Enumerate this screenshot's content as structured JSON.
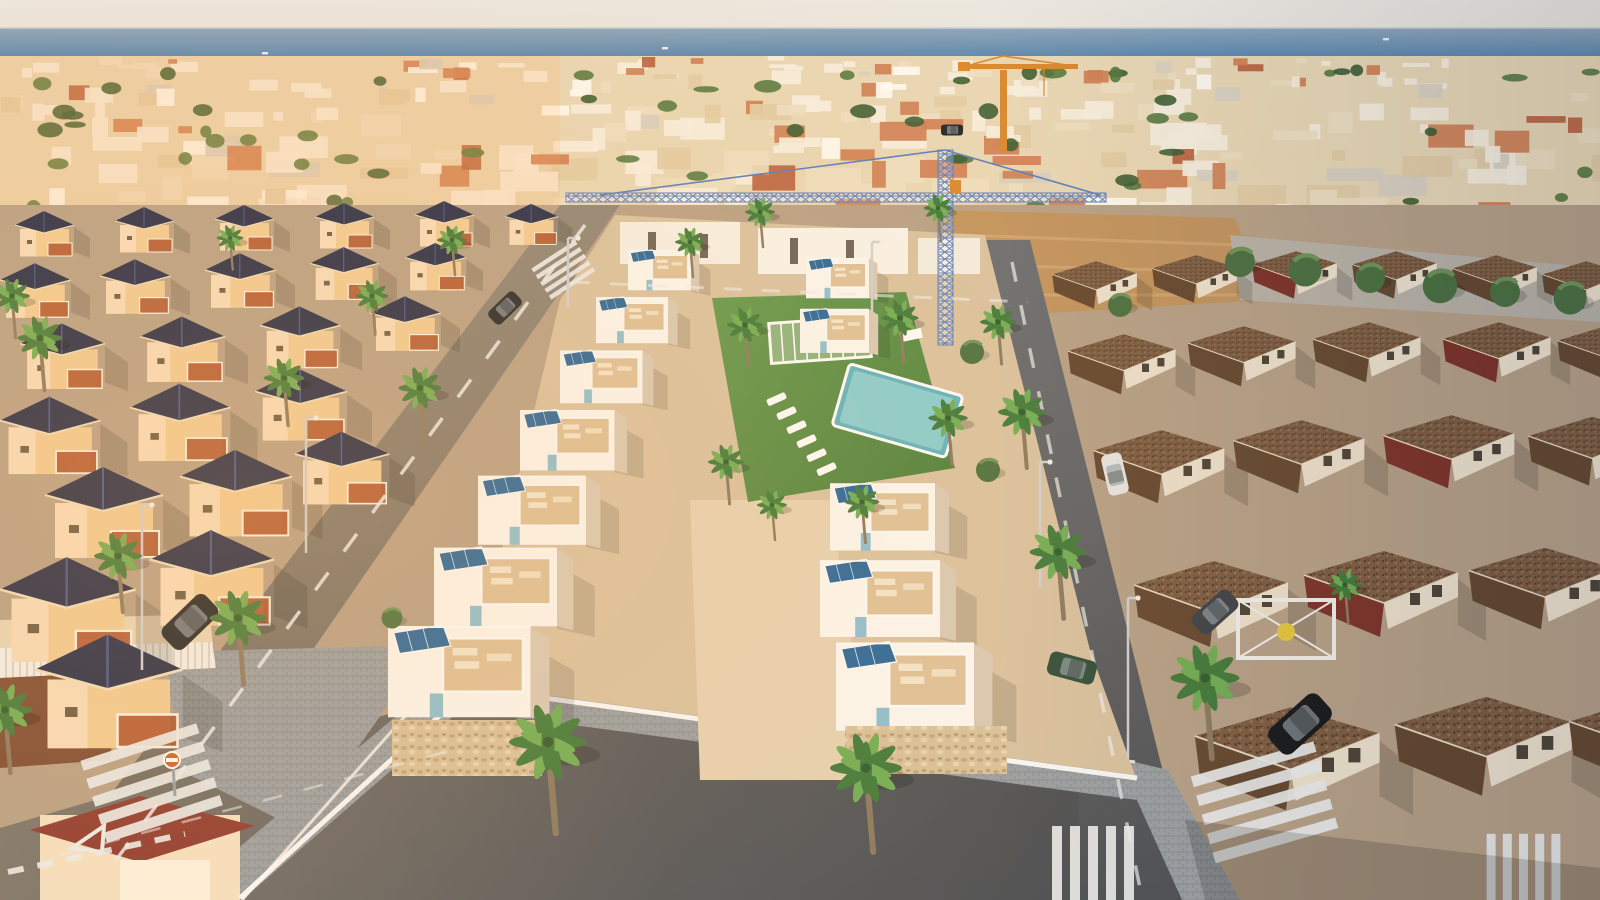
{
  "scene": {
    "description": "Aerial dusk render of a new-build white villa development with solar panels and communal pool beside the sea, surrounded by existing villas, streets, palms and two tower cranes",
    "colors": {
      "sky_top": "#ece9e2",
      "sky_bottom": "#e4e0d8",
      "sea_top": "#8ea6bb",
      "sea_mid": "#447aab",
      "sea_deep": "#2b669b",
      "town_base": "#e9d8b6",
      "ground": "#b7a188",
      "dirt_lot": "#c2945f",
      "asphalt": "#7b756c",
      "asphalt_dark": "#54575b",
      "asphalt_warm": "#8f8678",
      "paver": "#9aa0a5",
      "marking": "#eceeee",
      "lawn": "#61994d",
      "lawn_dark": "#4c7f3c",
      "pool_water": "#8fd4d6",
      "pool_deep": "#5fb4c2",
      "dev_wall": "#fcf9f3",
      "dev_wall_shadow": "#d8cab6",
      "dev_deck": "#dec29a",
      "dev_ground": "#d9c3a2",
      "dev_stone": "#d8c29c",
      "solar_panel": "#27679c",
      "solar_line": "#cfe3f2",
      "glass_blue": "#7fb9cf",
      "old_wall": "#f2cd96",
      "old_wall_lit": "#f8debd",
      "old_roof_navy": "#252c49",
      "old_roof_navy_hi": "#46558a",
      "old_terrace": "#b05530",
      "red_roof": "#8e3a30",
      "right_wall": "#efe3cf",
      "right_roof_brown": "#7d5c41",
      "right_roof_brown_dark": "#64472f",
      "right_roof_red": "#9b4334",
      "brick_wall": "#a05a48",
      "palm_dark": "#3f7a3a",
      "palm_light": "#6fae54",
      "palm_trunk": "#8a7a5f",
      "tree_green": "#4a7040",
      "crane_orange": "#d9892f",
      "crane_blue": "#5a7fc0",
      "lamp_gray": "#cfd2d4",
      "sign_orange": "#d2622a",
      "car_dark": "#23262b",
      "car_dark2": "#3c4148",
      "car_black": "#15171a",
      "car_white": "#e8e8e6",
      "car_green": "#2e4d3a"
    },
    "horizon_y": 28,
    "distant_town": {
      "seed": 7,
      "count": 270,
      "green_count": 62,
      "band": {
        "x": 0,
        "y": 56,
        "w": 1600,
        "h": 158
      },
      "palette": [
        "#f7f0e1",
        "#eee0c2",
        "#e2cda6",
        "#cf8055",
        "#b9623f",
        "#fffcf4",
        "#d8d0c2"
      ]
    },
    "boats": [
      {
        "x": 662,
        "y": 47
      },
      {
        "x": 1383,
        "y": 38
      },
      {
        "x": 262,
        "y": 52
      }
    ],
    "left_villas": {
      "units": [
        {
          "x": 15,
          "y": 210,
          "s": 0.5
        },
        {
          "x": 115,
          "y": 206,
          "s": 0.5
        },
        {
          "x": 215,
          "y": 204,
          "s": 0.5
        },
        {
          "x": 315,
          "y": 202,
          "s": 0.5
        },
        {
          "x": 415,
          "y": 200,
          "s": 0.5
        },
        {
          "x": 505,
          "y": 203,
          "s": 0.45
        },
        {
          "x": 0,
          "y": 262,
          "s": 0.6
        },
        {
          "x": 100,
          "y": 258,
          "s": 0.6
        },
        {
          "x": 205,
          "y": 252,
          "s": 0.6
        },
        {
          "x": 310,
          "y": 246,
          "s": 0.58
        },
        {
          "x": 405,
          "y": 242,
          "s": 0.52
        },
        {
          "x": 20,
          "y": 322,
          "s": 0.72
        },
        {
          "x": 140,
          "y": 315,
          "s": 0.72
        },
        {
          "x": 260,
          "y": 305,
          "s": 0.68
        },
        {
          "x": 370,
          "y": 295,
          "s": 0.6
        },
        {
          "x": 0,
          "y": 395,
          "s": 0.85
        },
        {
          "x": 130,
          "y": 382,
          "s": 0.85
        },
        {
          "x": 255,
          "y": 368,
          "s": 0.78
        },
        {
          "x": 45,
          "y": 465,
          "s": 1.0
        },
        {
          "x": 180,
          "y": 448,
          "s": 0.95
        },
        {
          "x": 295,
          "y": 430,
          "s": 0.8
        },
        {
          "x": 0,
          "y": 555,
          "s": 1.15
        },
        {
          "x": 150,
          "y": 528,
          "s": 1.05
        },
        {
          "x": 35,
          "y": 632,
          "s": 1.25
        }
      ]
    },
    "right_houses": {
      "units": [
        {
          "x": 1050,
          "y": 258,
          "s": 0.55
        },
        {
          "x": 1150,
          "y": 252,
          "s": 0.55
        },
        {
          "x": 1250,
          "y": 248,
          "s": 0.55,
          "red": true
        },
        {
          "x": 1350,
          "y": 248,
          "s": 0.55
        },
        {
          "x": 1450,
          "y": 252,
          "s": 0.55
        },
        {
          "x": 1540,
          "y": 258,
          "s": 0.55
        },
        {
          "x": 1065,
          "y": 330,
          "s": 0.7
        },
        {
          "x": 1185,
          "y": 322,
          "s": 0.7
        },
        {
          "x": 1310,
          "y": 318,
          "s": 0.7
        },
        {
          "x": 1440,
          "y": 318,
          "s": 0.7,
          "red": true
        },
        {
          "x": 1555,
          "y": 322,
          "s": 0.62
        },
        {
          "x": 1090,
          "y": 425,
          "s": 0.85
        },
        {
          "x": 1230,
          "y": 415,
          "s": 0.85
        },
        {
          "x": 1380,
          "y": 410,
          "s": 0.85,
          "red": true
        },
        {
          "x": 1525,
          "y": 412,
          "s": 0.8
        },
        {
          "x": 1130,
          "y": 555,
          "s": 1.0
        },
        {
          "x": 1300,
          "y": 545,
          "s": 1.0,
          "red": true
        },
        {
          "x": 1465,
          "y": 542,
          "s": 0.95
        },
        {
          "x": 1190,
          "y": 700,
          "s": 1.2
        },
        {
          "x": 1390,
          "y": 690,
          "s": 1.15
        },
        {
          "x": 1565,
          "y": 690,
          "s": 1.05
        }
      ]
    },
    "new_dev": {
      "left_row": [
        {
          "x": 628,
          "y": 242,
          "s": 0.42
        },
        {
          "x": 596,
          "y": 288,
          "s": 0.48
        },
        {
          "x": 560,
          "y": 340,
          "s": 0.55
        },
        {
          "x": 520,
          "y": 398,
          "s": 0.63
        },
        {
          "x": 478,
          "y": 462,
          "s": 0.72
        },
        {
          "x": 434,
          "y": 532,
          "s": 0.82
        },
        {
          "x": 388,
          "y": 608,
          "s": 0.95
        }
      ],
      "right_row": [
        {
          "x": 806,
          "y": 250,
          "s": 0.42
        },
        {
          "x": 800,
          "y": 300,
          "s": 0.46
        },
        {
          "x": 830,
          "y": 470,
          "s": 0.7
        },
        {
          "x": 820,
          "y": 545,
          "s": 0.8
        },
        {
          "x": 836,
          "y": 625,
          "s": 0.92
        }
      ]
    },
    "palms": [
      {
        "x": 548,
        "y": 742,
        "s": 1.3
      },
      {
        "x": 866,
        "y": 768,
        "s": 1.2
      },
      {
        "x": 238,
        "y": 618,
        "s": 0.95
      },
      {
        "x": 118,
        "y": 556,
        "s": 0.8
      },
      {
        "x": 420,
        "y": 388,
        "s": 0.72
      },
      {
        "x": 284,
        "y": 378,
        "s": 0.68
      },
      {
        "x": 372,
        "y": 296,
        "s": 0.55
      },
      {
        "x": 690,
        "y": 242,
        "s": 0.5
      },
      {
        "x": 760,
        "y": 212,
        "s": 0.5
      },
      {
        "x": 938,
        "y": 208,
        "s": 0.48
      },
      {
        "x": 1058,
        "y": 552,
        "s": 0.95
      },
      {
        "x": 1205,
        "y": 678,
        "s": 1.15
      },
      {
        "x": 1022,
        "y": 412,
        "s": 0.8
      },
      {
        "x": 998,
        "y": 322,
        "s": 0.6
      },
      {
        "x": 40,
        "y": 338,
        "s": 0.75
      },
      {
        "x": 12,
        "y": 296,
        "s": 0.6
      },
      {
        "x": 452,
        "y": 240,
        "s": 0.5
      },
      {
        "x": 230,
        "y": 238,
        "s": 0.45
      },
      {
        "x": 745,
        "y": 325,
        "s": 0.6
      },
      {
        "x": 900,
        "y": 318,
        "s": 0.62
      },
      {
        "x": 948,
        "y": 418,
        "s": 0.66
      },
      {
        "x": 726,
        "y": 462,
        "s": 0.6
      },
      {
        "x": 862,
        "y": 502,
        "s": 0.58
      },
      {
        "x": 772,
        "y": 505,
        "s": 0.5
      },
      {
        "x": 1345,
        "y": 585,
        "s": 0.55
      },
      {
        "x": 5,
        "y": 710,
        "s": 0.9
      }
    ],
    "trees": [
      {
        "x": 1240,
        "y": 262,
        "s": 1.0
      },
      {
        "x": 1305,
        "y": 270,
        "s": 1.1
      },
      {
        "x": 1370,
        "y": 278,
        "s": 1.0
      },
      {
        "x": 1440,
        "y": 286,
        "s": 1.15
      },
      {
        "x": 1505,
        "y": 292,
        "s": 1.0
      },
      {
        "x": 1570,
        "y": 298,
        "s": 1.1
      },
      {
        "x": 972,
        "y": 352,
        "s": 0.8
      },
      {
        "x": 988,
        "y": 470,
        "s": 0.8
      },
      {
        "x": 392,
        "y": 618,
        "s": 0.7
      },
      {
        "x": 1120,
        "y": 305,
        "s": 0.8
      }
    ],
    "cars": [
      {
        "x": 190,
        "y": 622,
        "s": 1.35,
        "rot": -44,
        "color": "car_dark"
      },
      {
        "x": 505,
        "y": 308,
        "s": 0.8,
        "rot": -44,
        "color": "car_dark"
      },
      {
        "x": 1115,
        "y": 474,
        "s": 0.95,
        "rot": 77,
        "color": "car_white"
      },
      {
        "x": 1072,
        "y": 668,
        "s": 1.1,
        "rot": 15,
        "color": "car_green"
      },
      {
        "x": 1300,
        "y": 724,
        "s": 1.5,
        "rot": -42,
        "color": "car_black"
      },
      {
        "x": 1215,
        "y": 612,
        "s": 1.1,
        "rot": -42,
        "color": "car_dark2"
      },
      {
        "x": 952,
        "y": 130,
        "s": 0.5,
        "rot": 0,
        "color": "car_dark"
      }
    ],
    "lamps": [
      {
        "x": 142,
        "y": 505,
        "h": 165
      },
      {
        "x": 306,
        "y": 418,
        "h": 135
      },
      {
        "x": 872,
        "y": 242,
        "h": 70
      },
      {
        "x": 1040,
        "y": 462,
        "h": 125
      },
      {
        "x": 1128,
        "y": 598,
        "h": 160
      },
      {
        "x": 568,
        "y": 238,
        "h": 70
      }
    ],
    "crosswalks": [
      {
        "x": 150,
        "y": 778,
        "rot": -18,
        "s": 1.05
      },
      {
        "x": 1263,
        "y": 797,
        "rot": -16,
        "s": 1.1
      },
      {
        "x": 1098,
        "y": 884,
        "rot": 90,
        "s": 1.0
      },
      {
        "x": 1528,
        "y": 886,
        "rot": 90,
        "s": 0.9
      },
      {
        "x": 562,
        "y": 268,
        "rot": -33,
        "s": 0.45
      }
    ],
    "loungers_pool": [
      {
        "x": 766,
        "y": 400
      },
      {
        "x": 776,
        "y": 414
      },
      {
        "x": 786,
        "y": 428
      },
      {
        "x": 796,
        "y": 442
      },
      {
        "x": 806,
        "y": 456
      },
      {
        "x": 816,
        "y": 470
      }
    ]
  }
}
